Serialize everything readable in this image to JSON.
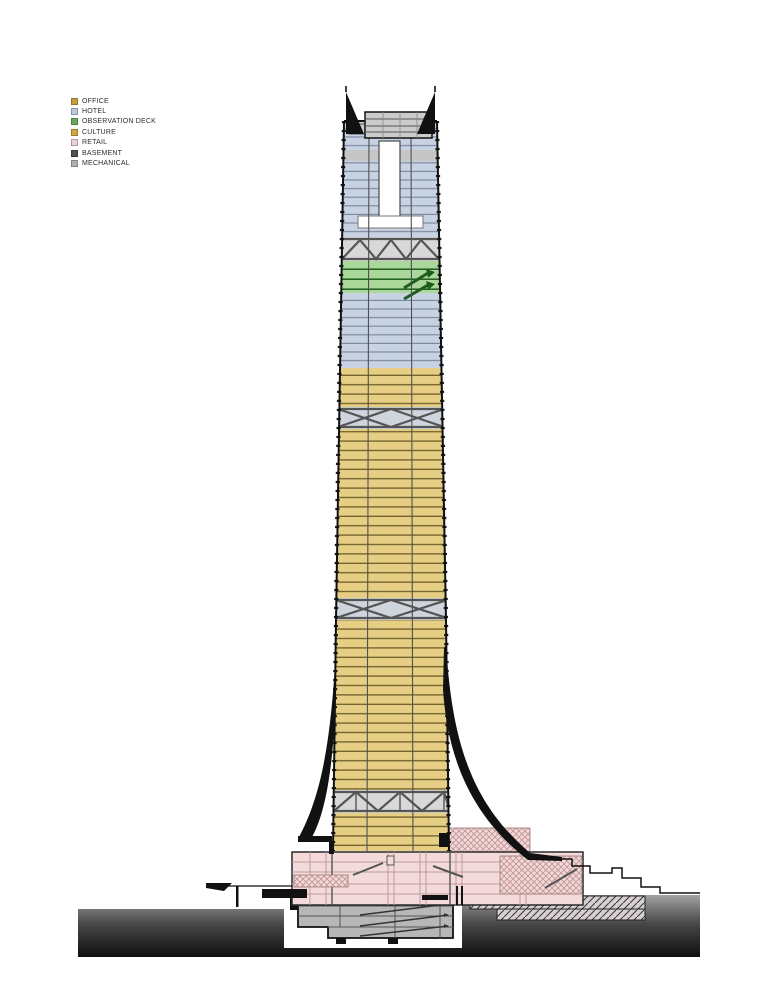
{
  "legend": {
    "items": [
      {
        "label": "OFFICE",
        "color": "#C59C3E"
      },
      {
        "label": "HOTEL",
        "color": "#BCC9E0"
      },
      {
        "label": "OBSERVATION DECK",
        "color": "#6BAA5B"
      },
      {
        "label": "CULTURE",
        "color": "#D3A440"
      },
      {
        "label": "RETAIL",
        "color": "#ECD2D2"
      },
      {
        "label": "BASEMENT",
        "color": "#505055"
      },
      {
        "label": "MECHANICAL",
        "color": "#AFAFB2"
      }
    ]
  },
  "diagram": {
    "type": "architectural-section",
    "subject": "supertall tower vertical program section",
    "zone_colors": {
      "office": "#E6CF85",
      "hotel": "#C7D2E3",
      "observation_deck": "#A9D89A",
      "retail": "#F3DBDB",
      "basement": "#B7B7B7",
      "mechanical": "#D8D8D8",
      "ground_top": "#A2A2A2",
      "ground_bottom": "#0E0E0E"
    },
    "stack_top_to_bottom": [
      "spires",
      "mechanical crown",
      "hotel with atrium",
      "mechanical truss",
      "observation deck",
      "hotel",
      "office",
      "mechanical truss",
      "office",
      "mechanical truss",
      "office",
      "mechanical truss",
      "office lobby",
      "retail podium",
      "basement with ramps",
      "ground"
    ]
  }
}
